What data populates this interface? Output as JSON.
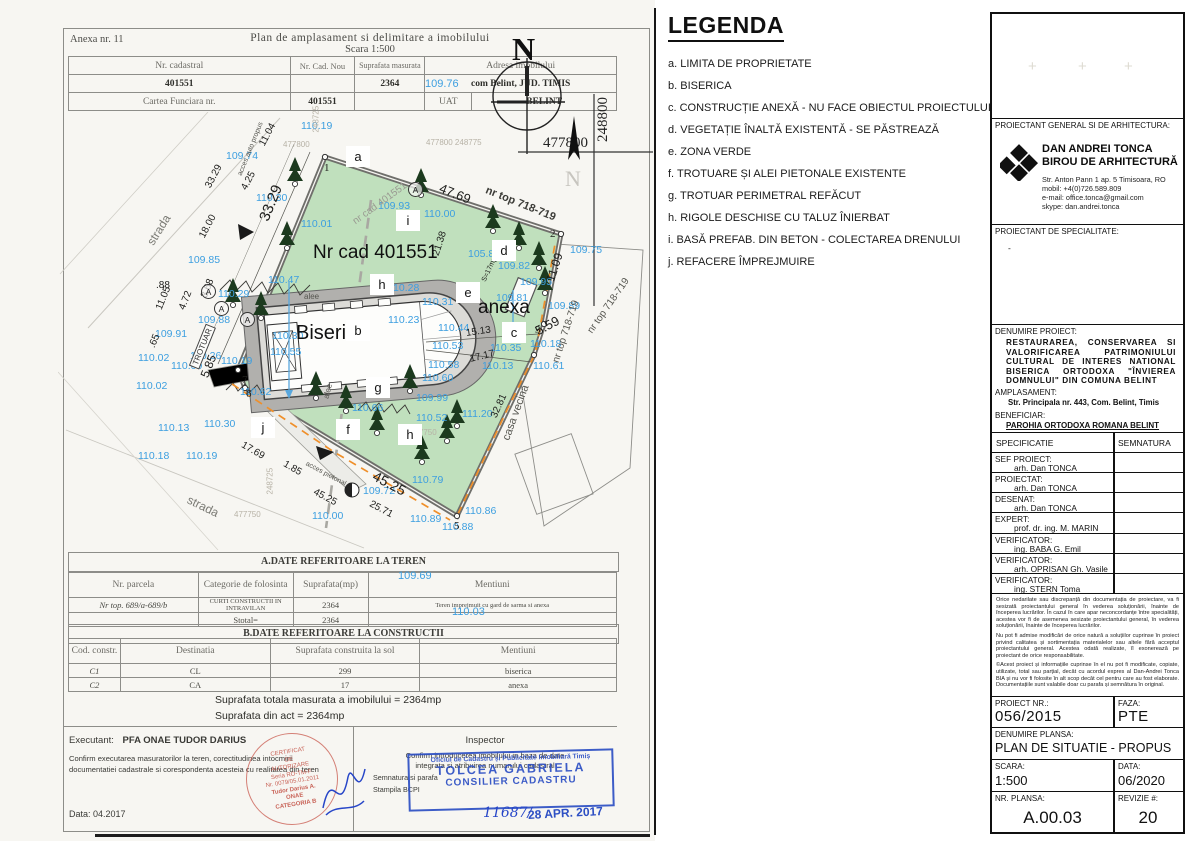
{
  "colors": {
    "elevation_blue": "#3d9fe0",
    "plan_green": "#c0e0bd",
    "tree_green": "#1c3a1e",
    "fence_orange": "#ef8f2a",
    "stamp_red": "#c0493c",
    "stamp_blue": "#2d4fc4"
  },
  "sheet": {
    "anexa": "Anexa nr. 11",
    "title": "Plan de amplasament si delimitare a imobilului",
    "scale": "Scara 1:500",
    "north": "N",
    "coord_x": "477800",
    "coord_y": "248800",
    "header_table": {
      "cols": [
        "Nr. cadastral",
        "Nr. Cad. Nou",
        "Suprafata masurata",
        "Adresa imobilului"
      ],
      "row1": [
        "401551",
        "",
        "2364",
        "com Belint, JUD. TIMIS"
      ],
      "row2_label": "Cartea Funciara nr.",
      "row2_value": "401551",
      "uat_label": "UAT",
      "uat_value": "BELINT"
    },
    "overlays": [
      {
        "t": "109.76",
        "x": 425,
        "y": 78
      },
      {
        "t": "109.69",
        "x": 398,
        "y": 570
      },
      {
        "t": "110.03",
        "x": 452,
        "y": 606
      }
    ],
    "section_a_title": "A.DATE REFERITOARE LA TEREN",
    "table_a": {
      "cols": [
        "Nr. parcela",
        "Categorie de folosinta",
        "Suprafata(mp)",
        "Mentiuni"
      ],
      "rows": [
        [
          "Nr top. 689/a-689/b",
          "CURTI CONSTRUCTII IN INTRAVILAN",
          "2364",
          "Teren imprejmuit cu gard de sarma si anexa"
        ],
        [
          "",
          "Stotal=",
          "2364",
          ""
        ]
      ]
    },
    "section_b_title": "B.DATE REFERITOARE LA CONSTRUCTII",
    "table_b": {
      "cols": [
        "Cod. constr.",
        "Destinatia",
        "Suprafata construita la sol",
        "Mentiuni"
      ],
      "rows": [
        [
          "C1",
          "CL",
          "299",
          "biserica"
        ],
        [
          "C2",
          "CA",
          "17",
          "anexa"
        ]
      ]
    },
    "totals": [
      "Suprafata totala masurata a imobilului = 2364mp",
      "Suprafata din act = 2364mp"
    ],
    "executant": {
      "label": "Executant:",
      "name": "PFA ONAE TUDOR DARIUS",
      "note": "Confirm executarea masuratorilor la teren, corectitudinea intocmirii documentatiei cadastrale si corespondenta acesteia cu realitatea din teren",
      "date_label": "Data:",
      "date": "04.2017",
      "stamp": [
        "CERTIFICAT",
        "DE",
        "AUTORIZARE",
        "Seria RO-TM-F",
        "Nr. 0079/05.01.2011",
        "Tudor Darius A.",
        "ONAE",
        "CATEGORIA B"
      ]
    },
    "inspector": {
      "label": "Inspector",
      "note1": "Confirm introducerea imobilului in baza de date",
      "note2": "integrata si atribuirea numarului cadastral",
      "note3": "Semnatura si parafa",
      "note4": "Stampila BCPI",
      "stamp_line1": "Oficiul de Cadastru și Publicitate Imobiliară Timiș",
      "stamp_name": "TOLCEA GABRIELA",
      "stamp_role": "CONSILIER CADASTRU",
      "reg_no": "11687/",
      "date_stamp": "28 APR. 2017"
    },
    "plan": {
      "elevations": [
        {
          "t": "110.19",
          "x": 243,
          "y": 8
        },
        {
          "t": "109.74",
          "x": 168,
          "y": 38
        },
        {
          "t": "110.30",
          "x": 198,
          "y": 80
        },
        {
          "t": "109.93",
          "x": 320,
          "y": 88
        },
        {
          "t": "110.00",
          "x": 366,
          "y": 96
        },
        {
          "t": "110.01",
          "x": 243,
          "y": 106
        },
        {
          "t": "109.85",
          "x": 130,
          "y": 142
        },
        {
          "t": "110.29",
          "x": 160,
          "y": 176
        },
        {
          "t": "109.88",
          "x": 140,
          "y": 202
        },
        {
          "t": "109.91",
          "x": 97,
          "y": 216
        },
        {
          "t": "110.26",
          "x": 132,
          "y": 238
        },
        {
          "t": "110.09",
          "x": 113,
          "y": 248
        },
        {
          "t": "110.02",
          "x": 80,
          "y": 240
        },
        {
          "t": "110.02",
          "x": 78,
          "y": 268
        },
        {
          "t": "110.13",
          "x": 100,
          "y": 310
        },
        {
          "t": "110.18",
          "x": 80,
          "y": 338
        },
        {
          "t": "110.19",
          "x": 128,
          "y": 338
        },
        {
          "t": "110.30",
          "x": 146,
          "y": 306
        },
        {
          "t": "110.47",
          "x": 210,
          "y": 162
        },
        {
          "t": "110.30",
          "x": 214,
          "y": 218
        },
        {
          "t": "110.55",
          "x": 212,
          "y": 234
        },
        {
          "t": "110.62",
          "x": 182,
          "y": 274
        },
        {
          "t": "110.19",
          "x": 163,
          "y": 243
        },
        {
          "t": "110.28",
          "x": 330,
          "y": 170
        },
        {
          "t": "110.31",
          "x": 364,
          "y": 184
        },
        {
          "t": "105.8",
          "x": 410,
          "y": 136
        },
        {
          "t": "109.82",
          "x": 440,
          "y": 148
        },
        {
          "t": "109.95",
          "x": 462,
          "y": 164
        },
        {
          "t": "109.81",
          "x": 438,
          "y": 180
        },
        {
          "t": "109.75",
          "x": 512,
          "y": 132
        },
        {
          "t": "109.89",
          "x": 490,
          "y": 188
        },
        {
          "t": "110.18",
          "x": 472,
          "y": 226
        },
        {
          "t": "110.61",
          "x": 475,
          "y": 248
        },
        {
          "t": "110.35",
          "x": 432,
          "y": 230
        },
        {
          "t": "110.13",
          "x": 424,
          "y": 248
        },
        {
          "t": "110.23",
          "x": 330,
          "y": 202
        },
        {
          "t": "110.44",
          "x": 380,
          "y": 210
        },
        {
          "t": "110.53",
          "x": 374,
          "y": 228
        },
        {
          "t": "110.58",
          "x": 370,
          "y": 247
        },
        {
          "t": "110.60",
          "x": 364,
          "y": 260
        },
        {
          "t": "109.99",
          "x": 358,
          "y": 280
        },
        {
          "t": "110.66",
          "x": 294,
          "y": 290
        },
        {
          "t": "110.52",
          "x": 358,
          "y": 300
        },
        {
          "t": "111.20",
          "x": 404,
          "y": 296
        },
        {
          "t": "110.79",
          "x": 354,
          "y": 362
        },
        {
          "t": "109.72",
          "x": 305,
          "y": 373
        },
        {
          "t": "110.00",
          "x": 254,
          "y": 398
        },
        {
          "t": "110.89",
          "x": 352,
          "y": 401
        },
        {
          "t": "110.86",
          "x": 407,
          "y": 393
        },
        {
          "t": "110.88",
          "x": 384,
          "y": 409
        }
      ],
      "dims": [
        {
          "t": "11.04",
          "x": 204,
          "y": 28,
          "r": -62
        },
        {
          "t": "4.25",
          "x": 186,
          "y": 72,
          "r": -62
        },
        {
          "t": "33.29",
          "x": 150,
          "y": 70,
          "r": -62
        },
        {
          "t": "33.29",
          "x": 206,
          "y": 100,
          "r": -68,
          "s": 15
        },
        {
          "t": "18.00",
          "x": 144,
          "y": 120,
          "r": -62
        },
        {
          "t": "3.68",
          "x": 146,
          "y": 180,
          "r": -68
        },
        {
          "t": "11.05",
          "x": 101,
          "y": 192,
          "r": -68
        },
        {
          "t": "4.72",
          "x": 124,
          "y": 192,
          "r": -68
        },
        {
          "t": ".88",
          "x": 98,
          "y": 168
        },
        {
          "t": ".65",
          "x": 94,
          "y": 230,
          "r": -68
        },
        {
          "t": "5.85",
          "x": 146,
          "y": 258,
          "r": -68,
          "s": 12
        },
        {
          "t": "47.69",
          "x": 382,
          "y": 68,
          "r": 22,
          "s": 13
        },
        {
          "t": "21.38",
          "x": 378,
          "y": 138,
          "r": -72
        },
        {
          "t": "11.09",
          "x": 492,
          "y": 162,
          "r": -72,
          "s": 12
        },
        {
          "t": "5.59",
          "x": 478,
          "y": 212,
          "r": -28,
          "s": 13
        },
        {
          "t": "15.13",
          "x": 408,
          "y": 216,
          "r": -8
        },
        {
          "t": "17.17",
          "x": 412,
          "y": 242,
          "r": -14
        },
        {
          "t": "32.81",
          "x": 436,
          "y": 300,
          "r": -66
        },
        {
          "t": "17.69",
          "x": 184,
          "y": 327,
          "r": 30
        },
        {
          "t": "1.85",
          "x": 226,
          "y": 346,
          "r": 30
        },
        {
          "t": "45.25",
          "x": 316,
          "y": 355,
          "r": 28,
          "s": 14
        },
        {
          "t": "45.25",
          "x": 256,
          "y": 374,
          "r": 28
        },
        {
          "t": "25.71",
          "x": 312,
          "y": 386,
          "r": 28
        },
        {
          "t": "S=17mp",
          "x": 426,
          "y": 166,
          "r": -65,
          "s": 7
        }
      ],
      "letters": [
        {
          "t": "a",
          "x": 288,
          "y": 34
        },
        {
          "t": "i",
          "x": 338,
          "y": 98
        },
        {
          "t": "d",
          "x": 434,
          "y": 128
        },
        {
          "t": "e",
          "x": 398,
          "y": 170
        },
        {
          "t": "h",
          "x": 312,
          "y": 162
        },
        {
          "t": "b",
          "x": 288,
          "y": 208
        },
        {
          "t": "c",
          "x": 444,
          "y": 210
        },
        {
          "t": "g",
          "x": 308,
          "y": 265
        },
        {
          "t": "f",
          "x": 278,
          "y": 307
        },
        {
          "t": "h",
          "x": 340,
          "y": 312
        },
        {
          "t": "j",
          "x": 193,
          "y": 305
        }
      ],
      "points": [
        {
          "t": "1",
          "x": 266,
          "y": 50
        },
        {
          "t": "2",
          "x": 492,
          "y": 116
        },
        {
          "t": "3",
          "x": 477,
          "y": 212
        },
        {
          "t": "5",
          "x": 396,
          "y": 408
        },
        {
          "t": "6",
          "x": 188,
          "y": 276
        },
        {
          "t": "7",
          "x": 184,
          "y": 262
        }
      ],
      "circled": [
        {
          "x": 143,
          "y": 172
        },
        {
          "x": 156,
          "y": 189
        },
        {
          "x": 182,
          "y": 200
        },
        {
          "x": 350,
          "y": 70
        }
      ],
      "texts": [
        {
          "t": "strada",
          "x": 92,
          "y": 125,
          "r": -58,
          "s": 12,
          "c": "#7a7a74"
        },
        {
          "t": "strada",
          "x": 130,
          "y": 380,
          "r": 26,
          "s": 12,
          "c": "#7a7a74"
        },
        {
          "t": "casa vecina",
          "x": 448,
          "y": 322,
          "r": -70,
          "s": 11,
          "c": "#55554f"
        },
        {
          "t": "nr top 718-719",
          "x": 428,
          "y": 72,
          "r": 22,
          "s": 11,
          "c": "#3c3c38",
          "b": true
        },
        {
          "t": "nr top 718-719",
          "x": 498,
          "y": 245,
          "r": -72,
          "s": 10,
          "c": "#55554f"
        },
        {
          "t": "nr top 718-719",
          "x": 532,
          "y": 215,
          "r": -55,
          "s": 10,
          "c": "#55554f"
        },
        {
          "t": "nr cad 401551",
          "x": 296,
          "y": 105,
          "r": -36,
          "s": 10,
          "c": "#9a9a92"
        },
        {
          "t": "Nr cad 401551",
          "x": 255,
          "y": 130,
          "s": 19,
          "c": "#101010"
        },
        {
          "t": "anexa",
          "x": 420,
          "y": 185,
          "s": 19,
          "c": "#101010"
        },
        {
          "t": "Biserica",
          "x": 238,
          "y": 210,
          "s": 20,
          "c": "#101010"
        },
        {
          "t": "alee",
          "x": 246,
          "y": 180,
          "s": 8,
          "c": "#55554f"
        },
        {
          "t": "alee",
          "x": 268,
          "y": 282,
          "r": -76,
          "s": 8,
          "c": "#55554f"
        },
        {
          "t": "acces auto propus",
          "x": 182,
          "y": 60,
          "r": -68,
          "s": 7,
          "c": "#55554f"
        },
        {
          "t": "acces pietonal",
          "x": 248,
          "y": 348,
          "r": 28,
          "s": 7,
          "c": "#55554f"
        },
        {
          "t": "477800",
          "x": 225,
          "y": 28,
          "s": 8,
          "c": "#b7b2a6"
        },
        {
          "t": "248725",
          "x": 258,
          "y": 16,
          "r": -90,
          "s": 8,
          "c": "#b7b2a6"
        },
        {
          "t": "477800  248775",
          "x": 368,
          "y": 26,
          "s": 8,
          "c": "#b7b2a6"
        },
        {
          "t": "477750",
          "x": 176,
          "y": 398,
          "s": 8,
          "c": "#b7b2a6"
        },
        {
          "t": "248725",
          "x": 212,
          "y": 378,
          "r": -90,
          "s": 8,
          "c": "#b7b2a6"
        },
        {
          "t": "477750",
          "x": 352,
          "y": 316,
          "s": 8,
          "c": "#b7b2a6"
        },
        {
          "t": "TROTUAR",
          "x": 136,
          "y": 250,
          "r": -68,
          "s": 8,
          "c": "#333",
          "box": true
        }
      ]
    }
  },
  "legend": {
    "title": "LEGENDA",
    "items": [
      {
        "key": "a.",
        "text": "LIMITA DE PROPRIETATE"
      },
      {
        "key": "b.",
        "text": "BISERICA"
      },
      {
        "key": "c.",
        "text": "CONSTRUCȚIE ANEXĂ - NU FACE OBIECTUL PROIECTULUI"
      },
      {
        "key": "d.",
        "text": "VEGETAȚIE ÎNALTĂ EXISTENTĂ - SE PĂSTREAZĂ"
      },
      {
        "key": "e.",
        "text": "ZONA VERDE"
      },
      {
        "key": "f.",
        "text": "TROTUARE ȘI ALEI PIETONALE EXISTENTE"
      },
      {
        "key": "g.",
        "text": "TROTUAR PERIMETRAL REFĂCUT"
      },
      {
        "key": "h.",
        "text": "RIGOLE DESCHISE CU TALUZ ÎNIERBAT"
      },
      {
        "key": "i.",
        "text": "BASĂ PREFAB. DIN BETON - COLECTAREA DRENULUI"
      },
      {
        "key": "j.",
        "text": "REFACERE ÎMPREJMUIRE"
      }
    ]
  },
  "titleblock": {
    "proiectant_general_label": "PROIECTANT GENERAL SI DE ARHITECTURA:",
    "firm_name_1": "DAN ANDREI TONCA",
    "firm_name_2": "BIROU DE ARHITECTURĂ",
    "firm_addr": [
      "Str. Anton Pann 1 ap. 5 Timisoara, RO",
      "mobil: +4(0)726.589.809",
      "e-mail: office.tonca@gmail.com",
      "skype: dan.andrei.tonca"
    ],
    "proiectant_spec_label": "PROIECTANT DE SPECIALITATE:",
    "proiectant_spec_value": "-",
    "denumire_label": "DENUMIRE PROIECT:",
    "denumire_value": "RESTAURAREA, CONSERVAREA SI VALORIFICAREA PATRIMONIULUI CULTURAL DE INTERES NATIONAL BISERICA ORTODOXA \"ÎNVIEREA DOMNULUI\" DIN COMUNA BELINT",
    "amplasament_label": "AMPLASAMENT:",
    "amplasament_value": "Str. Principala nr. 443, Com. Belint, Timis",
    "beneficiar_label": "BENEFICIAR:",
    "beneficiar_value": "PAROHIA ORTODOXA ROMANA BELINT",
    "spec_header": [
      "SPECIFICATIE",
      "SEMNATURA"
    ],
    "spec_rows": [
      {
        "role": "SEF PROIECT:",
        "name": "arh. Dan TONCA"
      },
      {
        "role": "PROIECTAT:",
        "name": "arh. Dan TONCA"
      },
      {
        "role": "DESENAT:",
        "name": "arh. Dan TONCA"
      },
      {
        "role": "EXPERT:",
        "name": "prof. dr. ing. M. MARIN"
      },
      {
        "role": "VERIFICATOR:",
        "name": "ing. BABA G. Emil"
      },
      {
        "role": "VERIFICATOR:",
        "name": "arh. OPRISAN Gh. Vasile"
      },
      {
        "role": "VERIFICATOR:",
        "name": "ing. STERN Toma"
      }
    ],
    "fine_print": [
      "Orice nedarilate sau discrepanță din documentația de proiectare, va fi sesizată proiectantului general în vederea soluționării, înainte de începerea lucrărilor. În cazul în care apar neconcordanțe între specialități, acestea vor fi de asemenea sesizate proiectantului general, în vederea soluționării, înainte de începerea lucrărilor.",
      "Nu pot fi admise modificări de orice natură a soluțiilor cuprinse în proiect privind calitatea și sortimentația materialelor sau altele fără acceptul proiectantului general. Acestea odată realizate, îl exonerează pe proiectant de orice responsabilitate.",
      "©Acest proiect și informațiile cuprinse în el nu pot fi modificate, copiate, utilizate, total sau parțial, decât cu acordul expres al Dan-Andrei Tonca BIA și nu vor fi folosite în alt scop decât cel pentru care au fost elaborate. Documentațiile sunt valabile doar cu parafa și semnătura în original."
    ],
    "proiect_nr_label": "PROIECT NR.:",
    "proiect_nr": "056/2015",
    "faza_label": "FAZA:",
    "faza": "PTE",
    "denumire_plansa_label": "DENUMIRE PLANSA:",
    "denumire_plansa": "PLAN DE SITUATIE - PROPUS",
    "scara_label": "SCARA:",
    "scara": "1:500",
    "data_label": "DATA:",
    "data_value": "06/2020",
    "nr_plansa_label": "NR. PLANSA:",
    "nr_plansa": "A.00.03",
    "revizie_label": "REVIZIE #:",
    "revizie": "20"
  }
}
